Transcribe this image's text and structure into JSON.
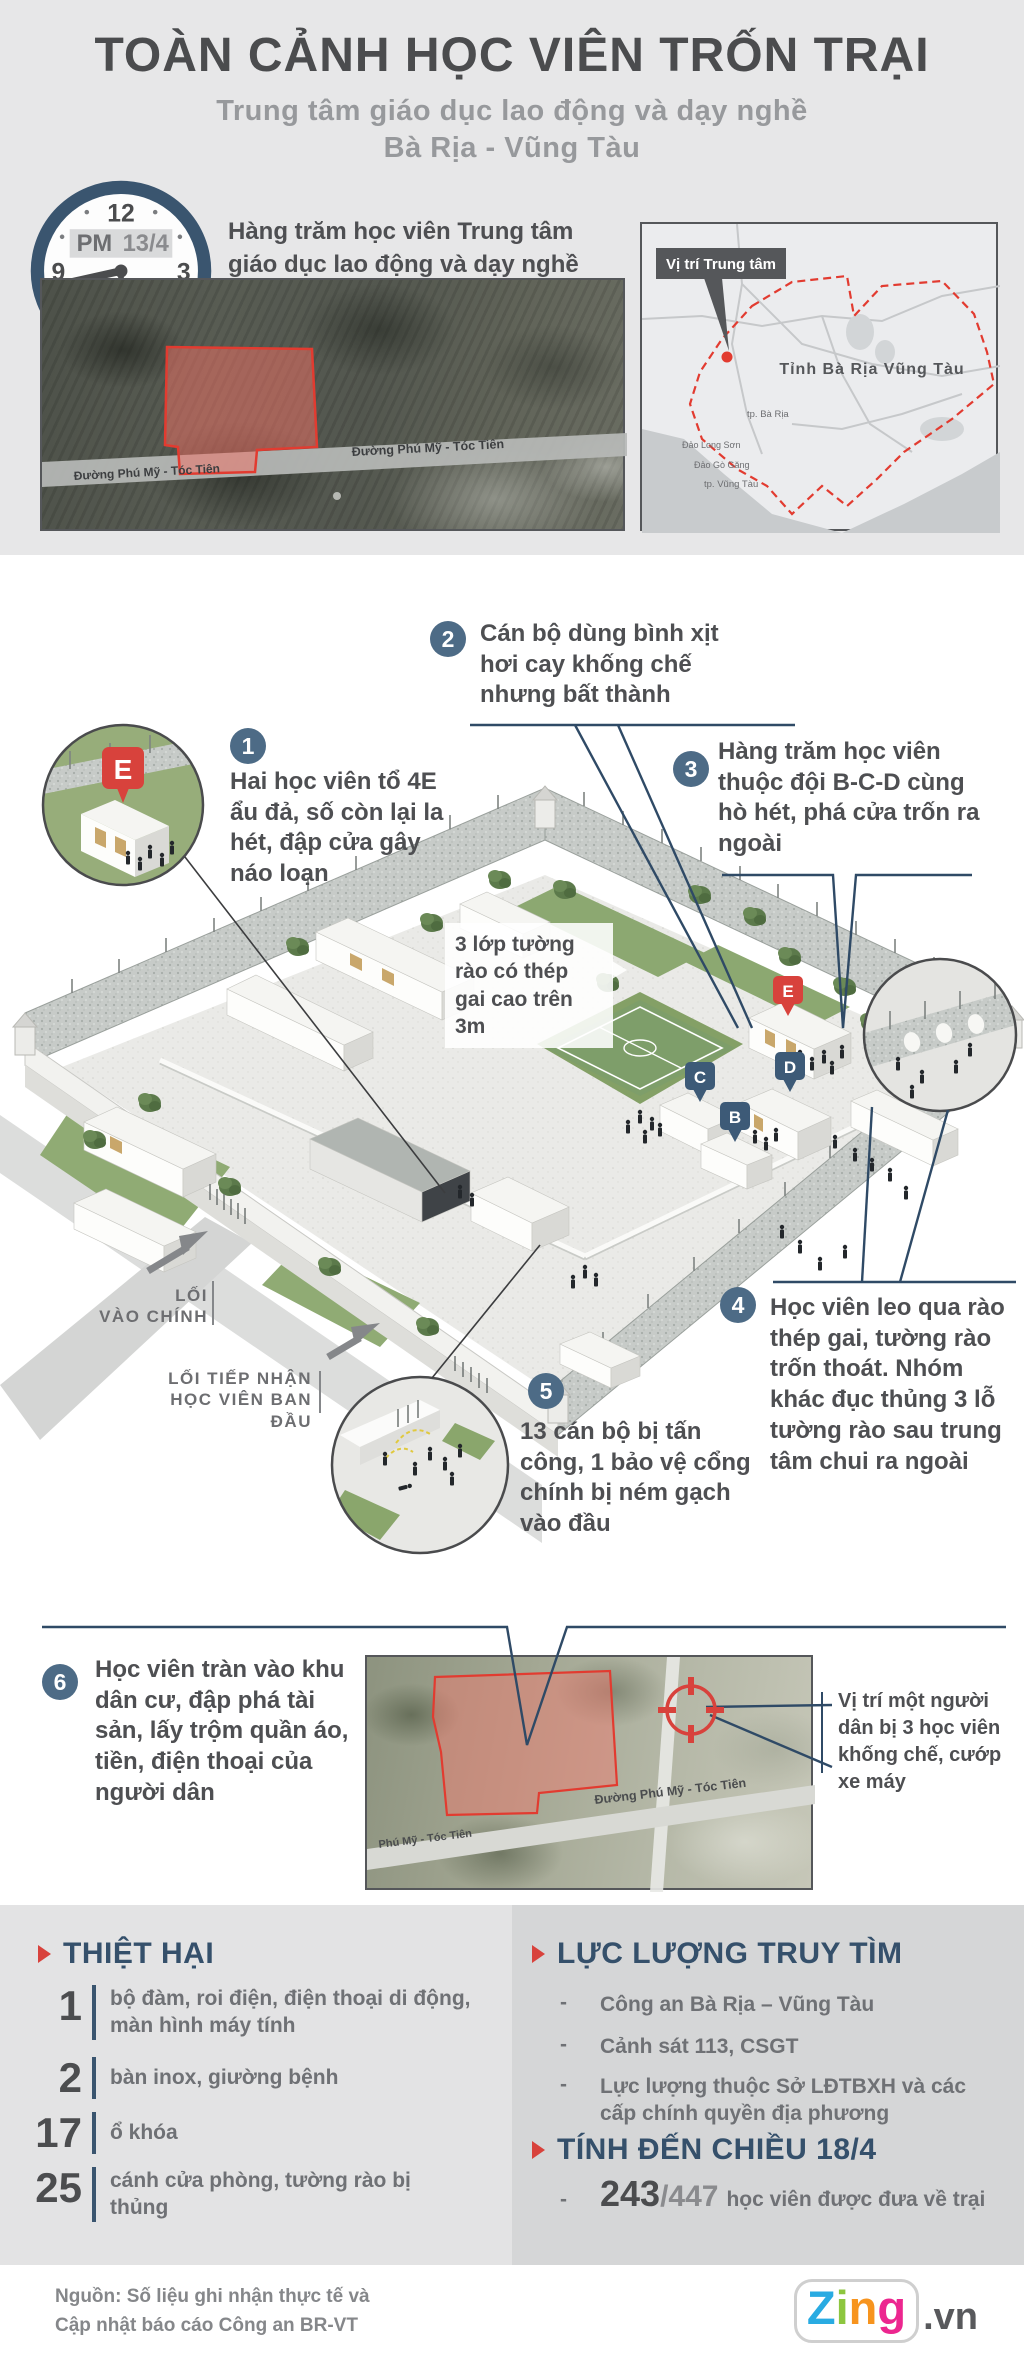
{
  "colors": {
    "accent_red": "#d8423c",
    "navy": "#35506b",
    "badge_blue": "#4d6b86",
    "text_dark": "#4e4f52",
    "text_gray": "#6f7175",
    "bg_gray": "#e7e7e8"
  },
  "header": {
    "title": "TOÀN CẢNH HỌC VIÊN TRỐN TRẠI",
    "subtitle1": "Trung tâm giáo dục lao động và dạy nghề",
    "subtitle2": "Bà Rịa - Vũng Tàu",
    "clock": {
      "period": "PM",
      "date": "13/4",
      "n12": "12",
      "n3": "3",
      "n6": "6",
      "n9": "9"
    },
    "intro": "Hàng trăm học viên Trung tâm giáo dục lao động và dạy nghề Bà Rịa - Vũng Tàu trốn thoát ra ngoài",
    "map_site": {
      "road_label_left": "Đường Phú Mỹ - Tóc Tiên",
      "road_label_right": "Đường Phú Mỹ - Tóc Tiên"
    },
    "map_province": {
      "callout": "Vị trí Trung tâm",
      "province": "Tỉnh Bà Rịa Vũng Tàu",
      "city1": "tp. Bà Rịa",
      "city2": "tp. Vũng Tàu",
      "island1": "Đảo Long Sơn",
      "island2": "Đảo Gò Găng"
    }
  },
  "diagram": {
    "markers": {
      "b": "B",
      "c": "C",
      "d": "D",
      "e": "E",
      "e_inset": "E"
    },
    "wall_note": "3 lớp tường rào có thép gai cao trên 3m",
    "entrance_main_1": "LỐI",
    "entrance_main_2": "VÀO CHÍNH",
    "entrance_intake_1": "LỐI TIẾP NHẬN",
    "entrance_intake_2": "HỌC VIÊN BAN ĐẦU",
    "steps": [
      {
        "n": "1",
        "text": "Hai học viên tổ 4E ẩu đả, số còn lại la hét, đập cửa gây náo loạn"
      },
      {
        "n": "2",
        "text": "Cán bộ dùng bình xịt hơi cay khống chế nhưng bất thành"
      },
      {
        "n": "3",
        "text": "Hàng trăm học viên thuộc đội B-C-D cùng hò hét, phá cửa trốn ra ngoài"
      },
      {
        "n": "4",
        "text": "Học viên leo qua rào thép gai, tường rào trốn thoát. Nhóm khác đục thủng 3 lỗ tường rào sau trung tâm chui ra ngoài"
      },
      {
        "n": "5",
        "text": "13 cán bộ bị tấn công, 1 bảo vệ cổng chính bị ném gạch vào đầu"
      },
      {
        "n": "6",
        "text": "Học viên tràn vào khu dân cư, đập phá tài sản, lấy trộm quần áo, tiền, điện thoại của người dân"
      }
    ],
    "map_escape": {
      "road_label_left": "Phú Mỹ - Tóc Tiên",
      "road_label_right": "Đường Phú Mỹ - Tóc Tiên",
      "annotation": "Vị trí một người dân bị 3 học viên khống chế, cướp xe máy"
    }
  },
  "damage": {
    "title": "THIỆT HẠI",
    "items": [
      {
        "n": "1",
        "text": "bộ đàm, roi điện, điện thoại di động, màn hình máy tính"
      },
      {
        "n": "2",
        "text": "bàn inox, giường bệnh"
      },
      {
        "n": "17",
        "text": "ổ khóa"
      },
      {
        "n": "25",
        "text": "cánh cửa phòng, tường rào bị thủng"
      }
    ]
  },
  "search": {
    "title": "LỰC LƯỢNG TRUY TÌM",
    "bullet": "-",
    "items": [
      "Công an Bà Rịa – Vũng Tàu",
      "Cảnh sát 113, CSGT",
      "Lực lượng thuộc Sở LĐTBXH và các cấp chính quyền địa phương"
    ]
  },
  "asof": {
    "title": "TÍNH ĐẾN CHIỀU 18/4",
    "bullet": "-",
    "returned": "243",
    "total": "/447",
    "text": "học viên được đưa về trại"
  },
  "footer": {
    "source_line1": "Nguồn: Số liệu ghi nhận thực tế và",
    "source_line2": "Cập nhật báo cáo Công an BR-VT",
    "brand_letters": [
      "Z",
      "i",
      "n",
      "g"
    ],
    "brand_suffix": ".vn"
  }
}
